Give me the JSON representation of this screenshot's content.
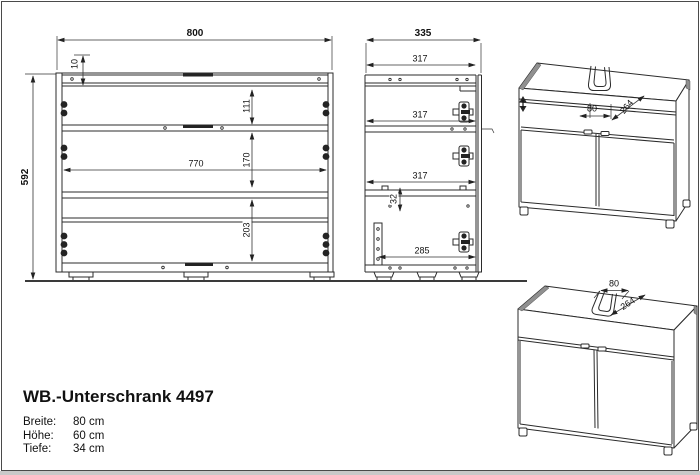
{
  "document": {
    "product": {
      "title": "WB.-Unterschrank 4497",
      "specs": [
        {
          "label": "Breite:",
          "value": "80 cm"
        },
        {
          "label": "Höhe:",
          "value": "60 cm"
        },
        {
          "label": "Tiefe:",
          "value": "34 cm"
        }
      ]
    },
    "front_view": {
      "dims": {
        "width": "800",
        "top_inset": "10",
        "height": "592",
        "inner_width": "770",
        "top_section": "111",
        "middle_section": "170",
        "bottom_section": "203"
      }
    },
    "side_view": {
      "dims": {
        "depth": "335",
        "inner_depth_top": "317",
        "inner_depth_middle": "317",
        "inner_depth_bottom": "317",
        "hole_offset": "32",
        "inner_depth_base": "285"
      }
    },
    "perspective_top": {
      "dims": {
        "cutout_width": "80",
        "cutout_depth": "264"
      }
    },
    "perspective_bottom": {
      "dims": {
        "cutout_width": "80",
        "cutout_depth": "264"
      }
    },
    "colors": {
      "line": "#2b2b2b",
      "dim_line": "#333333",
      "background": "#ffffff",
      "border": "#4a4a4a",
      "shadow": "#c9c9c9"
    }
  }
}
